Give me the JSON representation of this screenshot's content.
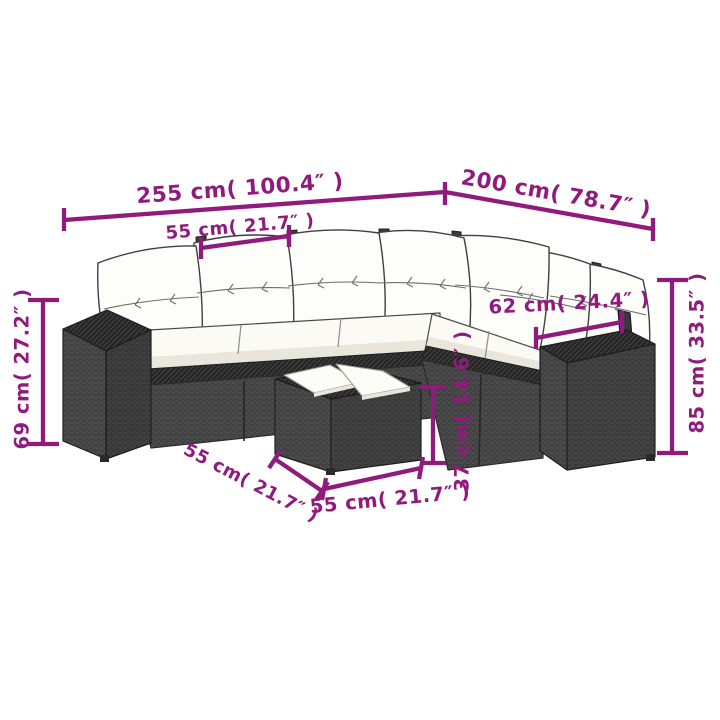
{
  "colors": {
    "accent": "#901b7d",
    "background": "#ffffff",
    "rattan_mid": "#4a4a4a",
    "rattan_dark": "#2c2c2c",
    "cushion": "#fdfdfa"
  },
  "dimensions": {
    "overall_width": "255 cm( 100.4″ )",
    "overall_depth": "200 cm( 78.7″ )",
    "seat_width": "55 cm( 21.7″ )",
    "armrest_height": "69 cm( 27.2″ )",
    "back_height": "85 cm( 33.5″ )",
    "corner_module_width": "62 cm( 24.4″ )",
    "table_height": "37 cm( 14.6″ )",
    "table_depth": "55 cm( 21.7″ )",
    "table_width": "55 cm( 21.7″ )"
  }
}
